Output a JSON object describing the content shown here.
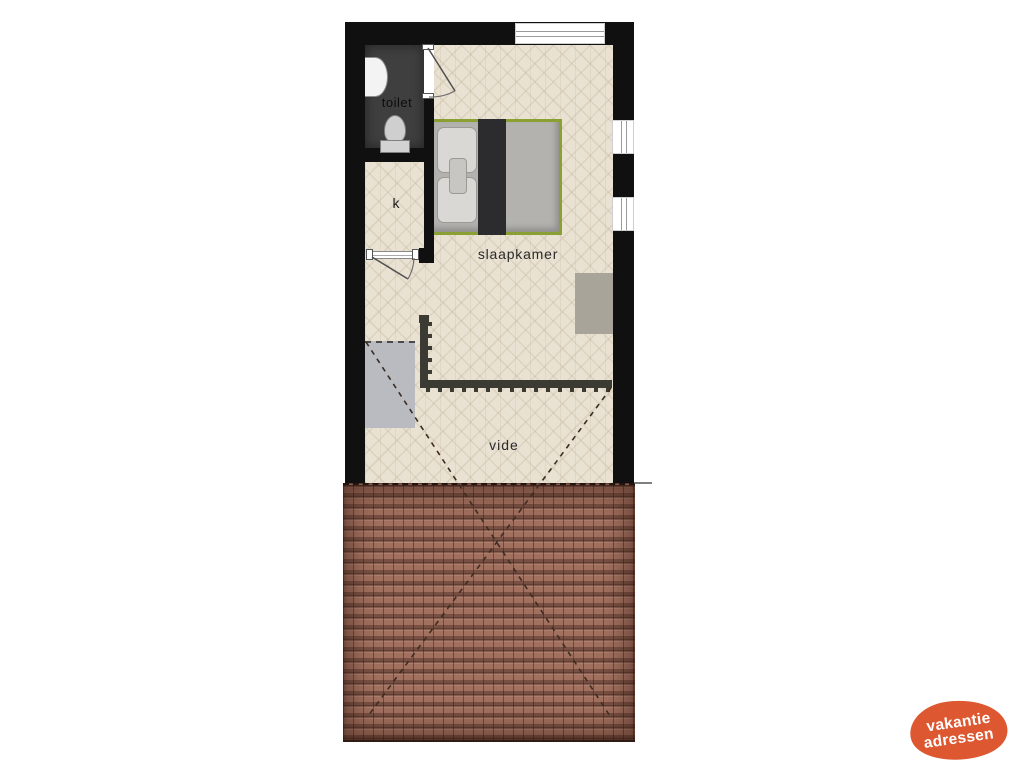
{
  "plan": {
    "rooms": [
      {
        "id": "toilet",
        "label": "toilet"
      },
      {
        "id": "kast",
        "label": "k"
      },
      {
        "id": "slaapkamer",
        "label": "slaapkamer"
      },
      {
        "id": "vide",
        "label": "vide"
      }
    ]
  },
  "logo": {
    "line1": "vakantie",
    "line2": "adressen",
    "color": "#dd5730"
  },
  "colors": {
    "wall": "#101010",
    "floor": "#e9e1d2",
    "toilet_floor": "#3f3f3f",
    "roof_tiles": "#a1705f",
    "bed_frame_green": "#8aa033",
    "blanket_dark": "#2c2c2e",
    "furniture_gray": "#a8a49a",
    "stairs_gray": "#b9bbc0",
    "railing": "#3b3a33",
    "logo_orange": "#dd5730"
  }
}
